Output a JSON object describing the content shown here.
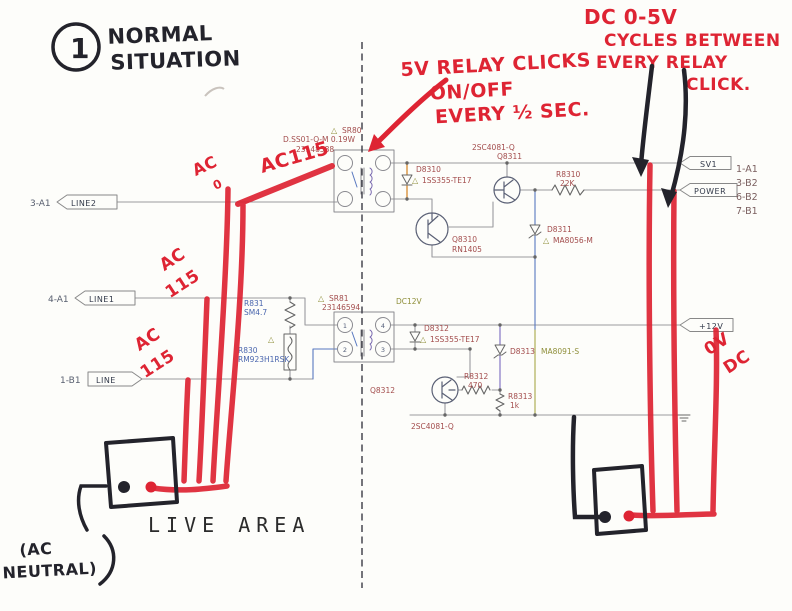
{
  "colors": {
    "red_marker": "#de2433",
    "black_marker": "#23232b",
    "wire_gray": "#9a9a9e",
    "label_maroon": "#a34d4d",
    "label_blue": "#4a66ae",
    "label_olive": "#8f8f3a",
    "orange": "#d78a2e"
  },
  "note_topleft": {
    "number": "1",
    "line1": "NORMAL",
    "line2": "SITUATION"
  },
  "note_relay": {
    "line1": "5V RELAY CLICKS",
    "line2": "ON/OFF",
    "line3": "EVERY ½ SEC."
  },
  "note_dc": {
    "line1": "DC 0-5V",
    "line2": "CYCLES BETWEEN",
    "line3": "EVERY RELAY",
    "line4": "CLICK."
  },
  "note_ac_phase": {
    "line1": "AC",
    "line2": "0"
  },
  "note_ac115_top": "AC115",
  "note_ac115_mid": {
    "line1": "AC",
    "line2": "115"
  },
  "note_ac115_low": {
    "line1": "AC",
    "line2": "115"
  },
  "note_0vdc": {
    "line1": "0V",
    "line2": "DC"
  },
  "note_ac_neutral": {
    "line1": "(AC",
    "line2": "NEUTRAL)"
  },
  "live_area": "LIVE AREA",
  "warn": "△",
  "connectors": {
    "line2": {
      "pin": "3-A1",
      "label": "LINE2"
    },
    "line1": {
      "pin": "4-A1",
      "label": "LINE1"
    },
    "line": {
      "pin": "1-B1",
      "label": "LINE"
    },
    "sv1": "SV1",
    "power": "POWER",
    "v12": "+12V",
    "pins_right": [
      "1-A1",
      "3-B2",
      "6-B2",
      "7-B1"
    ]
  },
  "relay1": {
    "ref": "SR80",
    "desc": "D.SS01-Q-M  0.19W",
    "code": "23148588"
  },
  "relay2": {
    "ref": "SR81",
    "code": "23146594",
    "coil": "DC12V",
    "p1": "1",
    "p2": "2",
    "p3": "3",
    "p4": "4"
  },
  "parts": {
    "d8310": {
      "ref": "D8310",
      "val": "1SS355-TE17"
    },
    "d8311": {
      "ref": "D8311",
      "val": "MA8056-M"
    },
    "d8312": {
      "ref": "D8312",
      "val": "1SS355-TE17"
    },
    "d8313": {
      "ref": "D8313",
      "val": "MA8091-S"
    },
    "q8310": {
      "ref": "Q8310",
      "val": "RN1405"
    },
    "q8311": {
      "ref": "Q8311",
      "val": "2SC4081-Q"
    },
    "q8312": {
      "ref": "Q8312",
      "val": "2SC4081-Q"
    },
    "r8310": {
      "ref": "R8310",
      "val": "22K"
    },
    "r8312": {
      "ref": "R8312",
      "val": "470"
    },
    "r8313": {
      "ref": "R8313",
      "val": "1k"
    },
    "r831": {
      "ref": "R831",
      "val": "SM4.7"
    },
    "r830": {
      "ref": "R830",
      "val": "RM923H1RSK"
    }
  }
}
